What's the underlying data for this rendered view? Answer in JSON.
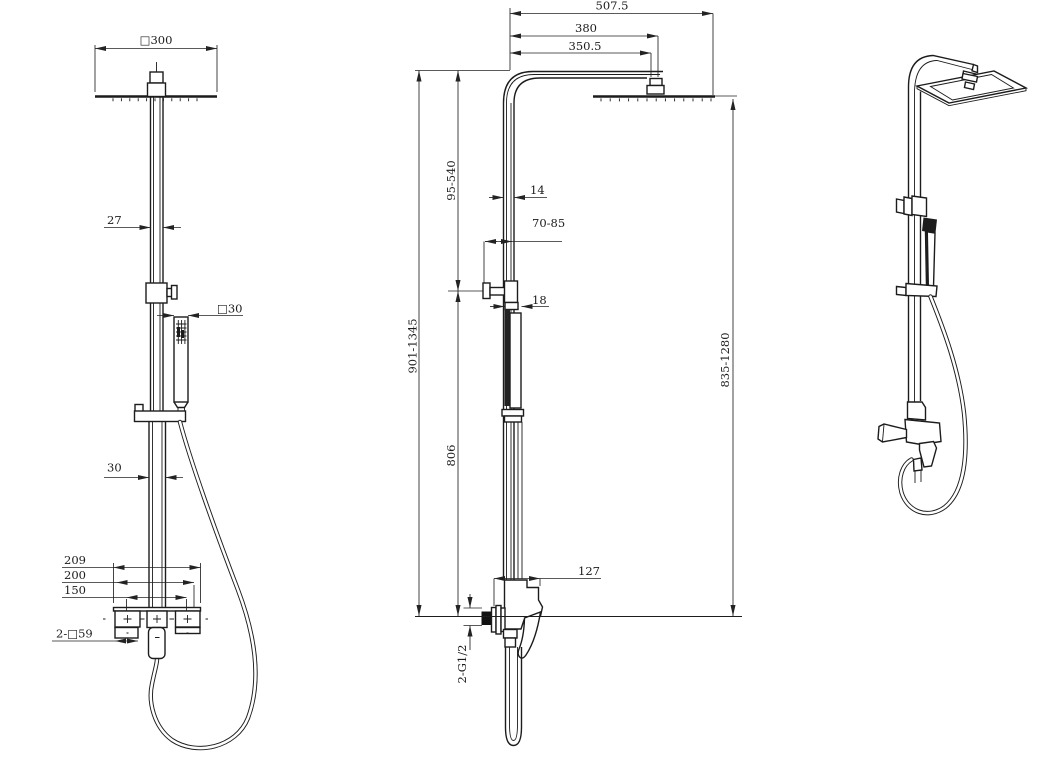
{
  "drawing": {
    "background": "#ffffff",
    "ink": "#1c1c1c",
    "dim_ink": "#232323"
  },
  "front": {
    "head_width": "□300",
    "upper_pipe": "27",
    "hand_shower": "□30",
    "lower_pipe": "30",
    "valve_overall": "209",
    "valve_body": "200",
    "inlet_centers": "150",
    "escutcheons": "2-□59"
  },
  "side": {
    "overall_reach": "507.5",
    "arm_reach": "380",
    "arm_inner_reach": "350.5",
    "riser_adjust": "95-540",
    "pipe_section": "14",
    "bracket_adjust": "70-85",
    "hand_shower_section": "18",
    "overall_height": "901-1345",
    "riser_height": "806",
    "head_height": "835-1280",
    "valve_reach": "127",
    "inlets": "2-G1/2"
  }
}
